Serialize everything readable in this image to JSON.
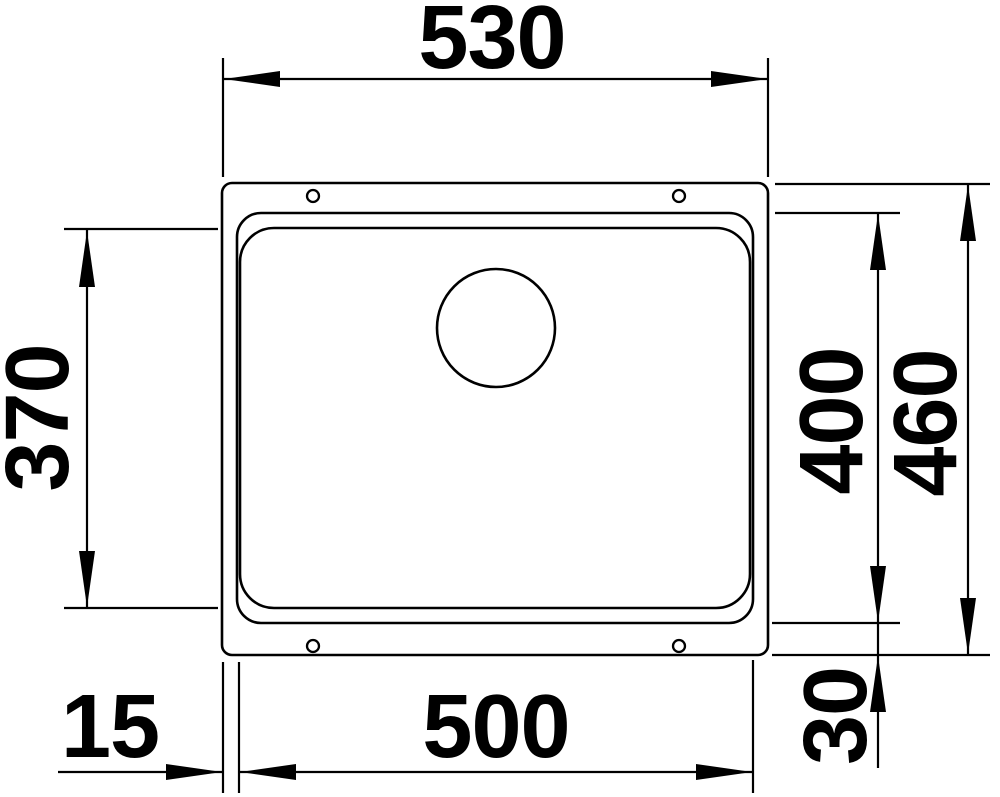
{
  "drawing": {
    "background_color": "#ffffff",
    "line_color": "#000000",
    "labels": {
      "top_width": "530",
      "left_inner_height": "370",
      "right_inner_height": "400",
      "right_outer_height": "460",
      "bottom_inner_width": "500",
      "bottom_left_offset": "15",
      "bottom_right_offset": "30"
    }
  }
}
